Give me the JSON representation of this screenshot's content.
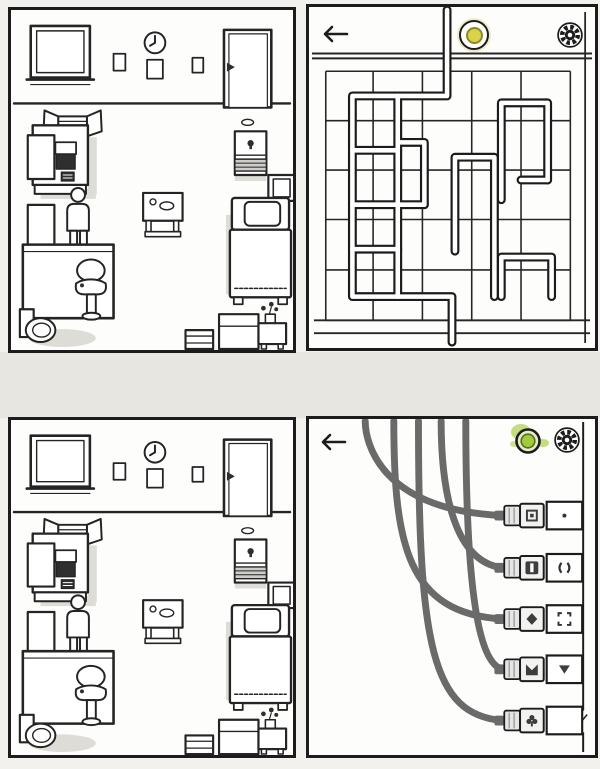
{
  "meta": {
    "scene": "four-panel game screenshot",
    "panel_names": [
      "bedroom-overview-top",
      "pipe-maze-puzzle",
      "bedroom-overview-bottom",
      "cable-plug-puzzle"
    ]
  },
  "colors": {
    "page_bg": "#f3f1ed",
    "gap_bg": "#e8e6e1",
    "panel_bg": "#fdfdfc",
    "ink": "#1c1c1c",
    "shadow": "#dedcd7",
    "pipe_fill": "#ffffff",
    "cable": "#6a6a6a",
    "yellow_button": "#d8d348",
    "yellow_button_rim": "#8f8a25",
    "green_button": "#a3c93c",
    "green_glow": "#b5d55f"
  },
  "room": {
    "objects": [
      "window",
      "picture-frame-small-1",
      "wall-clock",
      "picture-frame-small-2",
      "picture-frame-small-3",
      "door",
      "armchair",
      "desk",
      "wardrobe",
      "side-table",
      "person",
      "sink-counter",
      "mirror",
      "sink",
      "toilet",
      "small-table",
      "nightstand",
      "wall-cabinet",
      "bed",
      "dresser",
      "plant-table",
      "drawer-stack"
    ]
  },
  "pipe_puzzle": {
    "icons": {
      "back": "arrow-left-icon",
      "indicator": "yellow-round-button",
      "settings": "gear-icon"
    },
    "grid": {
      "cols_x": [
        17,
        65,
        115,
        165,
        215,
        265
      ],
      "rows_y": [
        65,
        115,
        165,
        215,
        266,
        317
      ],
      "grid_top": 65,
      "grid_bottom": 317,
      "grid_left": 17,
      "grid_right": 265,
      "header_divider_y": [
        47,
        52
      ],
      "baseboard_y": [
        317,
        330
      ],
      "right_wall_x": 280
    },
    "pipe_segments": [
      [
        [
          140,
          3
        ],
        [
          140,
          90
        ],
        [
          44,
          90
        ],
        [
          44,
          293
        ],
        [
          145,
          293
        ],
        [
          145,
          339
        ]
      ],
      [
        [
          90,
          90
        ],
        [
          90,
          293
        ]
      ],
      [
        [
          44,
          145
        ],
        [
          90,
          145
        ]
      ],
      [
        [
          44,
          200
        ],
        [
          117,
          200
        ]
      ],
      [
        [
          44,
          245
        ],
        [
          90,
          245
        ]
      ],
      [
        [
          90,
          137
        ],
        [
          117,
          137
        ],
        [
          117,
          200
        ]
      ],
      [
        [
          148,
          247
        ],
        [
          148,
          152
        ],
        [
          188,
          152
        ],
        [
          188,
          247
        ],
        [
          188,
          293
        ]
      ],
      [
        [
          195,
          195
        ],
        [
          195,
          97
        ],
        [
          242,
          97
        ],
        [
          242,
          175
        ]
      ],
      [
        [
          215,
          175
        ],
        [
          242,
          175
        ]
      ],
      [
        [
          195,
          293
        ],
        [
          195,
          253
        ],
        [
          246,
          253
        ],
        [
          246,
          293
        ]
      ]
    ]
  },
  "cable_puzzle": {
    "icons": {
      "back": "arrow-left-icon",
      "indicator": "green-round-button-glowing",
      "settings": "gear-icon"
    },
    "cable_tops_x": [
      57,
      86,
      111,
      134,
      159
    ],
    "socket_rows_y": [
      98,
      151,
      203,
      254,
      306
    ],
    "cable_to_socket": [
      0,
      2,
      4,
      1,
      3
    ],
    "right_wall_x": 278,
    "sockets": [
      {
        "plug_symbol": "square-ring",
        "wall_symbol": "dot"
      },
      {
        "plug_symbol": "vertical-bar",
        "wall_symbol": "parentheses"
      },
      {
        "plug_symbol": "diamond",
        "wall_symbol": "corner-brackets"
      },
      {
        "plug_symbol": "crown-m",
        "wall_symbol": "triangle-down"
      },
      {
        "plug_symbol": "club",
        "wall_symbol": "four-dots"
      }
    ]
  }
}
